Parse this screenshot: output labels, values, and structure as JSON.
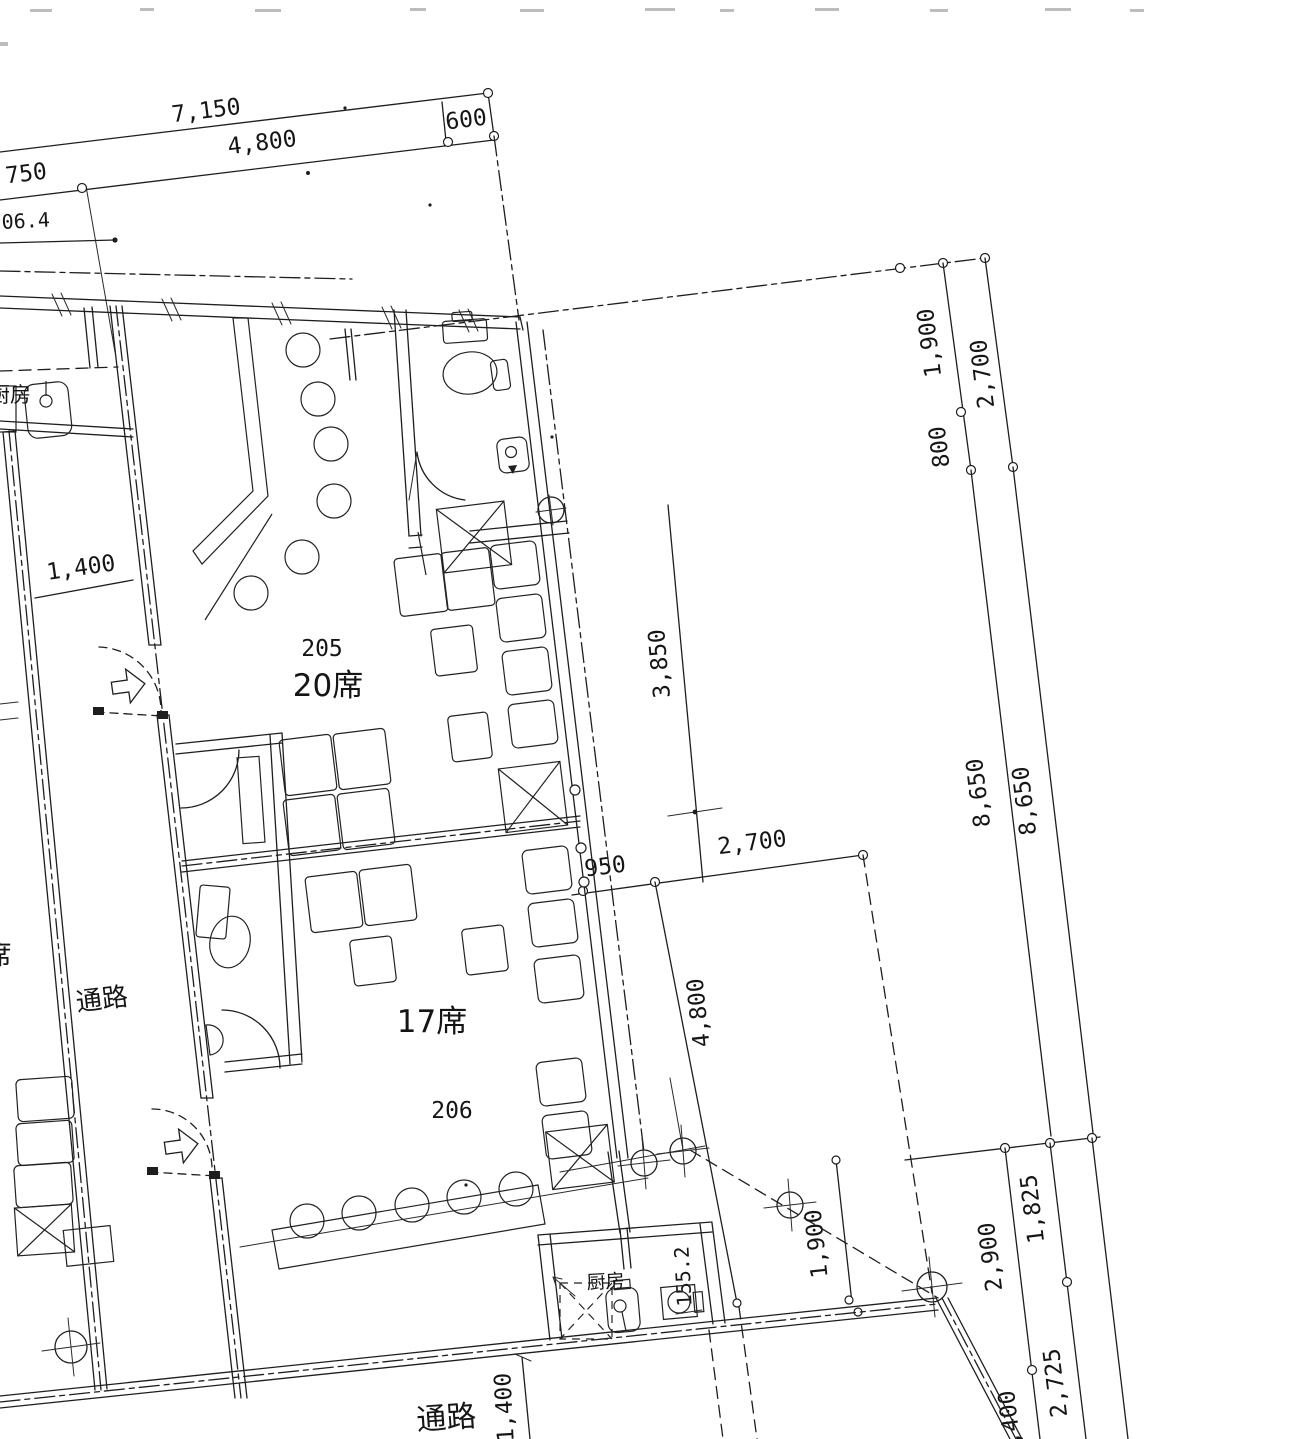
{
  "document": {
    "kind": "scanned architectural floor plan",
    "language": "ja"
  },
  "rooms": {
    "room205": {
      "number": "205",
      "seats": "20席"
    },
    "room206": {
      "number": "206",
      "seats": "17席"
    }
  },
  "labels": {
    "corridor_left": "通路",
    "corridor_bottom": "通路",
    "kitchen_bottom": "厨房",
    "kitchen_left": "厨房",
    "seats_partial": "席"
  },
  "dimensions": {
    "top": {
      "total": "7,150",
      "main": "4,800",
      "right": "600",
      "left": "750",
      "partial": "06.4"
    },
    "right_upper": {
      "a": "1,900",
      "b": "2,700",
      "c": "800"
    },
    "right_main": {
      "inner": "8,650",
      "outer": "8,650"
    },
    "bottom_right": {
      "a": "1,825",
      "b": "2,900",
      "c": "2,725",
      "d": "1,400"
    },
    "middle": {
      "a": "3,850",
      "b": "950",
      "c": "2,700",
      "d": "4,800",
      "e": "1,900"
    },
    "left": {
      "corridor_width": "1,400"
    },
    "bottom": {
      "corridor": "1,400",
      "kitchen": "155.2"
    }
  }
}
